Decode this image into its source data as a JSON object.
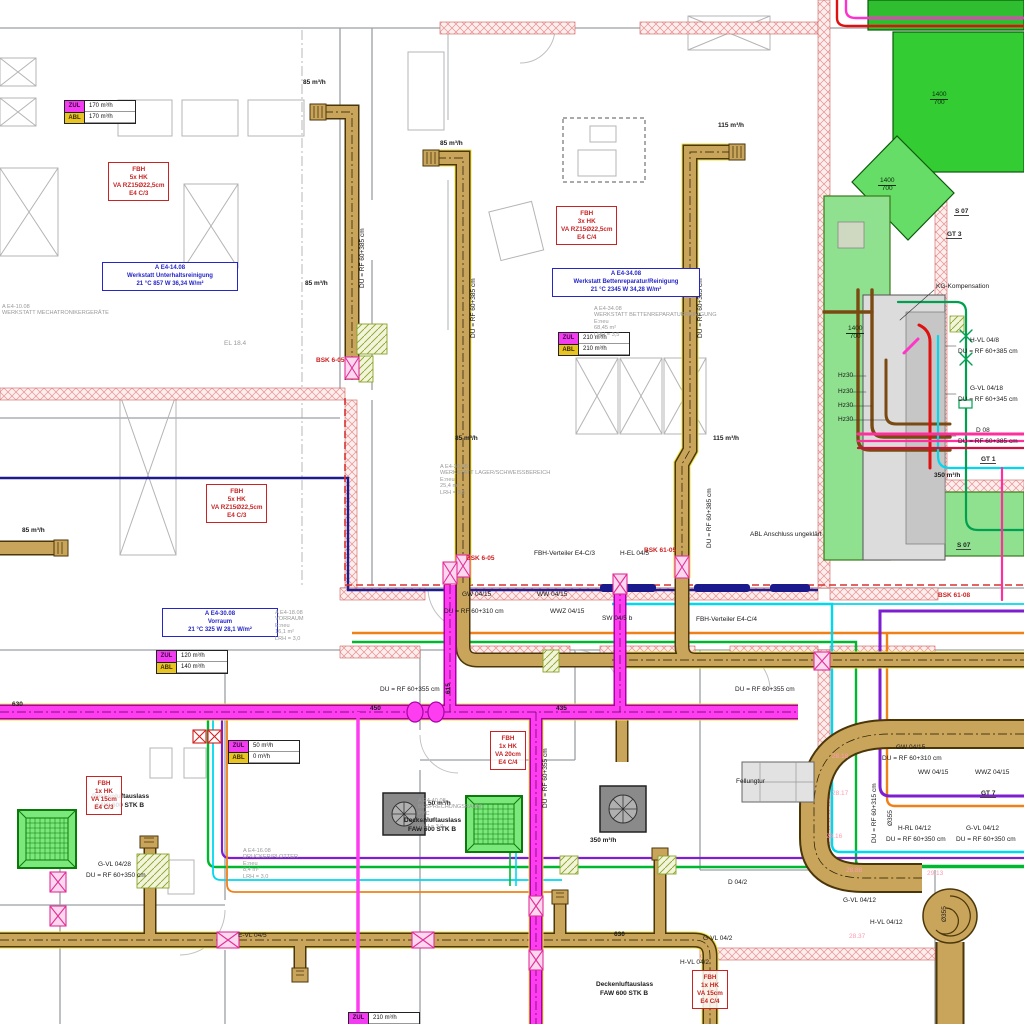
{
  "colors": {
    "duct_tan": "#c9a45b",
    "duct_magenta": "#ff3df0",
    "duct_green_dark": "#2fbe2f",
    "duct_green_light": "#8fe08f",
    "pipe_orange": "#f08018",
    "pipe_green": "#00b830",
    "pipe_cyan": "#00d8ee",
    "pipe_purple": "#7d1fd1",
    "pipe_navy": "#1c1c8e",
    "pipe_red": "#e01010",
    "pipe_brown": "#7b4a12",
    "wall_hatch": "#e89090",
    "label_red": "#cc2020",
    "label_blue": "#2626c8"
  },
  "flow_tables": [
    {
      "x": 64,
      "y": 100,
      "rows": [
        {
          "tag": "ZUL",
          "value": "170 m³/h"
        },
        {
          "tag": "ABL",
          "value": "170 m³/h"
        }
      ]
    },
    {
      "x": 558,
      "y": 332,
      "rows": [
        {
          "tag": "ZUL",
          "value": "210 m³/h"
        },
        {
          "tag": "ABL",
          "value": "210 m³/h"
        }
      ]
    },
    {
      "x": 156,
      "y": 650,
      "rows": [
        {
          "tag": "ZUL",
          "value": "120 m³/h"
        },
        {
          "tag": "ABL",
          "value": "140 m³/h"
        }
      ]
    },
    {
      "x": 228,
      "y": 740,
      "rows": [
        {
          "tag": "ZUL",
          "value": "50 m³/h"
        },
        {
          "tag": "ABL",
          "value": "0 m³/h"
        }
      ]
    },
    {
      "x": 348,
      "y": 1012,
      "rows": [
        {
          "tag": "ZUL",
          "value": "210 m³/h"
        },
        {
          "tag": "ABL",
          "value": "210 m³/h"
        }
      ]
    }
  ],
  "fbh_boxes": [
    {
      "x": 108,
      "y": 162,
      "lines": [
        "FBH",
        "5x HK",
        "VA RZ15Ø22,5cm",
        "E4 C/3"
      ]
    },
    {
      "x": 556,
      "y": 206,
      "lines": [
        "FBH",
        "3x HK",
        "VA RZ15Ø22,5cm",
        "E4 C/4"
      ]
    },
    {
      "x": 206,
      "y": 484,
      "lines": [
        "FBH",
        "5x HK",
        "VA RZ15Ø22,5cm",
        "E4 C/3"
      ]
    },
    {
      "x": 490,
      "y": 731,
      "lines": [
        "FBH",
        "1x HK",
        "VA 20cm",
        "E4 C/4"
      ]
    },
    {
      "x": 86,
      "y": 776,
      "lines": [
        "FBH",
        "1x HK",
        "VA 15cm",
        "E4 C/3"
      ]
    },
    {
      "x": 692,
      "y": 970,
      "lines": [
        "FBH",
        "1x HK",
        "VA 15cm",
        "E4 C/4"
      ]
    }
  ],
  "room_boxes": [
    {
      "x": 102,
      "y": 262,
      "w": 128,
      "lines": [
        "A E4-14.08",
        "Werkstatt Unterhaltsreinigung",
        "21 °C 857 W 36,34 W/m²"
      ]
    },
    {
      "x": 552,
      "y": 268,
      "w": 140,
      "lines": [
        "A E4-34.08",
        "Werkstatt Bettenreparatur/Reinigung",
        "21 °C 2345 W 34,28 W/m²"
      ]
    },
    {
      "x": 162,
      "y": 608,
      "w": 108,
      "lines": [
        "A E4-30.08",
        "Vorraum",
        "21 °C 325 W 28,1 W/m²"
      ]
    }
  ],
  "gray_texts": [
    {
      "x": 594,
      "y": 306,
      "lines": [
        "A E4-34.08",
        "WERKSTATT BETTENREPARATURREINIGUNG",
        "E:neu",
        "68,45 m²",
        "LRH = 3,5"
      ]
    },
    {
      "x": 440,
      "y": 464,
      "lines": [
        "A E4-30.08",
        "WERKSTATT LAGER/SCHWEISSBEREICH",
        "E:neu",
        "25,4 m²",
        "LRH = 3,5"
      ]
    },
    {
      "x": 275,
      "y": 610,
      "lines": [
        "A E4-18.08",
        "VORRAUM",
        "E:neu",
        "16,1 m²",
        "LRH = 3,0"
      ]
    },
    {
      "x": 418,
      "y": 798,
      "lines": [
        "A E4-40.08",
        "BESPRECHUNGSRAUM",
        "PVC",
        "24,1 m²",
        "LRH = 3,0"
      ]
    },
    {
      "x": 243,
      "y": 848,
      "lines": [
        "A E4-16.08",
        "DRUCKER/PLOTTER",
        "E:neu",
        "8,4 m²",
        "LRH = 3,0"
      ]
    },
    {
      "x": 2,
      "y": 304,
      "lines": [
        "A E4-10.08",
        "WERKSTATT MECHATRONIKERGERÄTE"
      ]
    }
  ],
  "tags": [
    {
      "x": 954,
      "y": 208,
      "t": "S 07"
    },
    {
      "x": 946,
      "y": 231,
      "t": "GT 3"
    },
    {
      "x": 956,
      "y": 542,
      "t": "S 07"
    },
    {
      "x": 980,
      "y": 456,
      "t": "GT 1"
    },
    {
      "x": 980,
      "y": 790,
      "t": "GT 7"
    }
  ],
  "fractions": [
    {
      "x": 930,
      "y": 92,
      "top": "1400",
      "bottom": "700"
    },
    {
      "x": 878,
      "y": 178,
      "top": "1400",
      "bottom": "700"
    },
    {
      "x": 846,
      "y": 326,
      "top": "1400",
      "bottom": "700"
    }
  ],
  "labels": [
    {
      "t": "85 m³/h",
      "x": 303,
      "y": 80,
      "b": 1
    },
    {
      "t": "85 m³/h",
      "x": 440,
      "y": 141,
      "b": 1
    },
    {
      "t": "115 m³/h",
      "x": 718,
      "y": 123,
      "b": 1
    },
    {
      "t": "85 m³/h",
      "x": 305,
      "y": 281,
      "b": 1
    },
    {
      "t": "85 m³/h",
      "x": 455,
      "y": 436,
      "b": 1
    },
    {
      "t": "115 m³/h",
      "x": 713,
      "y": 436,
      "b": 1
    },
    {
      "t": "85 m³/h",
      "x": 22,
      "y": 528,
      "b": 1
    },
    {
      "t": "50 m³/h",
      "x": 428,
      "y": 801,
      "b": 1
    },
    {
      "t": "350 m³/h",
      "x": 590,
      "y": 838,
      "b": 1
    },
    {
      "t": "350 m³/h",
      "x": 934,
      "y": 473,
      "b": 1
    },
    {
      "t": "BSK 6-05",
      "x": 316,
      "y": 358,
      "c": "#cc2020",
      "b": 1
    },
    {
      "t": "BSK 6-05",
      "x": 466,
      "y": 556,
      "c": "#cc2020",
      "b": 1
    },
    {
      "t": "BSK 61-05",
      "x": 644,
      "y": 548,
      "c": "#cc2020",
      "b": 1
    },
    {
      "t": "BSK 61-08",
      "x": 938,
      "y": 593,
      "c": "#cc2020",
      "b": 1
    },
    {
      "t": "H-EL 04/5",
      "x": 620,
      "y": 551
    },
    {
      "t": "SW 04/5 b",
      "x": 602,
      "y": 616
    },
    {
      "t": "FBH-Verteiler E4-C/3",
      "x": 534,
      "y": 551
    },
    {
      "t": "FBH-Verteiler E4-C/4",
      "x": 696,
      "y": 617
    },
    {
      "t": "GW 04/15",
      "x": 462,
      "y": 592
    },
    {
      "t": "WW 04/15",
      "x": 537,
      "y": 592
    },
    {
      "t": "WWZ 04/15",
      "x": 550,
      "y": 609
    },
    {
      "t": "DU = RF 60+310 cm",
      "x": 444,
      "y": 609
    },
    {
      "t": "GW 04/15",
      "x": 896,
      "y": 745
    },
    {
      "t": "DU = RF 60+310 cm",
      "x": 882,
      "y": 756
    },
    {
      "t": "WW 04/15",
      "x": 918,
      "y": 770
    },
    {
      "t": "WWZ 04/15",
      "x": 975,
      "y": 770
    },
    {
      "t": "H-RL 04/12",
      "x": 898,
      "y": 826
    },
    {
      "t": "DU = RF 60+350 cm",
      "x": 886,
      "y": 837
    },
    {
      "t": "G-VL 04/12",
      "x": 966,
      "y": 826
    },
    {
      "t": "DU = RF 60+350 cm",
      "x": 956,
      "y": 837
    },
    {
      "t": "G-VL 04/12",
      "x": 843,
      "y": 898
    },
    {
      "t": "H-VL 04/12",
      "x": 870,
      "y": 920
    },
    {
      "t": "G-VL 04/28",
      "x": 98,
      "y": 862
    },
    {
      "t": "DU = RF 60+350 cm",
      "x": 86,
      "y": 873
    },
    {
      "t": "E-VL 04/5",
      "x": 238,
      "y": 933
    },
    {
      "t": "G-VL 04/2",
      "x": 703,
      "y": 936
    },
    {
      "t": "H-VL 04/2",
      "x": 680,
      "y": 960
    },
    {
      "t": "D 04/2",
      "x": 728,
      "y": 880
    },
    {
      "t": "Hz30",
      "x": 838,
      "y": 373
    },
    {
      "t": "Hz30",
      "x": 838,
      "y": 389
    },
    {
      "t": "Hz30",
      "x": 838,
      "y": 403
    },
    {
      "t": "Hz30",
      "x": 838,
      "y": 417
    },
    {
      "t": "H-VL 04/8",
      "x": 970,
      "y": 338
    },
    {
      "t": "DU = RF 60+385 cm",
      "x": 958,
      "y": 349
    },
    {
      "t": "G-VL 04/18",
      "x": 970,
      "y": 386
    },
    {
      "t": "DU = RF 60+345 cm",
      "x": 958,
      "y": 397
    },
    {
      "t": "D 08",
      "x": 976,
      "y": 428
    },
    {
      "t": "DU = RF 60+385 cm",
      "x": 958,
      "y": 439
    },
    {
      "t": "KG-Kompensation",
      "x": 936,
      "y": 284
    },
    {
      "t": "ABL Anschluss ungeklärt",
      "x": 750,
      "y": 532
    },
    {
      "t": "EL 18.4",
      "x": 224,
      "y": 341,
      "c": "#999"
    },
    {
      "t": "Fellungtur",
      "x": 736,
      "y": 779
    },
    {
      "t": "DU = RF 60+385 cm",
      "x": 360,
      "y": 288,
      "r": -90
    },
    {
      "t": "DU = RF 60+385 cm",
      "x": 471,
      "y": 338,
      "r": -90
    },
    {
      "t": "DU = RF 60+385 cm",
      "x": 698,
      "y": 338,
      "r": -90
    },
    {
      "t": "DU = RF 60+385 cm",
      "x": 707,
      "y": 548,
      "r": -90
    },
    {
      "t": "DU = RF 60+355 cm",
      "x": 380,
      "y": 687
    },
    {
      "t": "DU = RF 60+355 cm",
      "x": 735,
      "y": 687
    },
    {
      "t": "DU = RF 60+355 cm",
      "x": 543,
      "y": 808,
      "r": -90
    },
    {
      "t": "450",
      "x": 370,
      "y": 706,
      "b": 1
    },
    {
      "t": "435",
      "x": 556,
      "y": 706,
      "b": 1
    },
    {
      "t": "630",
      "x": 12,
      "y": 702,
      "b": 1
    },
    {
      "t": "630",
      "x": 614,
      "y": 932,
      "b": 1
    },
    {
      "t": "615",
      "x": 446,
      "y": 694,
      "r": -90,
      "b": 1
    },
    {
      "t": "DU = RF 60+315 cm",
      "x": 872,
      "y": 843,
      "r": -90
    },
    {
      "t": "Ø355",
      "x": 888,
      "y": 826,
      "r": -90
    },
    {
      "t": "Ø355",
      "x": 942,
      "y": 922,
      "r": -90
    },
    {
      "t": "28.18",
      "x": 832,
      "y": 754,
      "c": "#ff9bb0"
    },
    {
      "t": "28.17",
      "x": 832,
      "y": 791,
      "c": "#ff9bb0"
    },
    {
      "t": "28.16",
      "x": 826,
      "y": 834,
      "c": "#ff9bb0"
    },
    {
      "t": "28.88",
      "x": 846,
      "y": 868,
      "c": "#ff9bb0"
    },
    {
      "t": "29.13",
      "x": 927,
      "y": 871,
      "c": "#ff9bb0"
    },
    {
      "t": "28.37",
      "x": 849,
      "y": 934,
      "c": "#ff9bb0"
    },
    {
      "t": "Deckenluftauslass",
      "x": 92,
      "y": 794,
      "b": 1
    },
    {
      "t": "FAW 600 STK B",
      "x": 96,
      "y": 803,
      "b": 1
    },
    {
      "t": "Deckenluftauslass",
      "x": 404,
      "y": 818,
      "b": 1
    },
    {
      "t": "FAW 600 STK B",
      "x": 408,
      "y": 827,
      "b": 1
    },
    {
      "t": "Deckenluftauslass",
      "x": 596,
      "y": 982,
      "b": 1
    },
    {
      "t": "FAW 600 STK B",
      "x": 600,
      "y": 991,
      "b": 1
    }
  ]
}
